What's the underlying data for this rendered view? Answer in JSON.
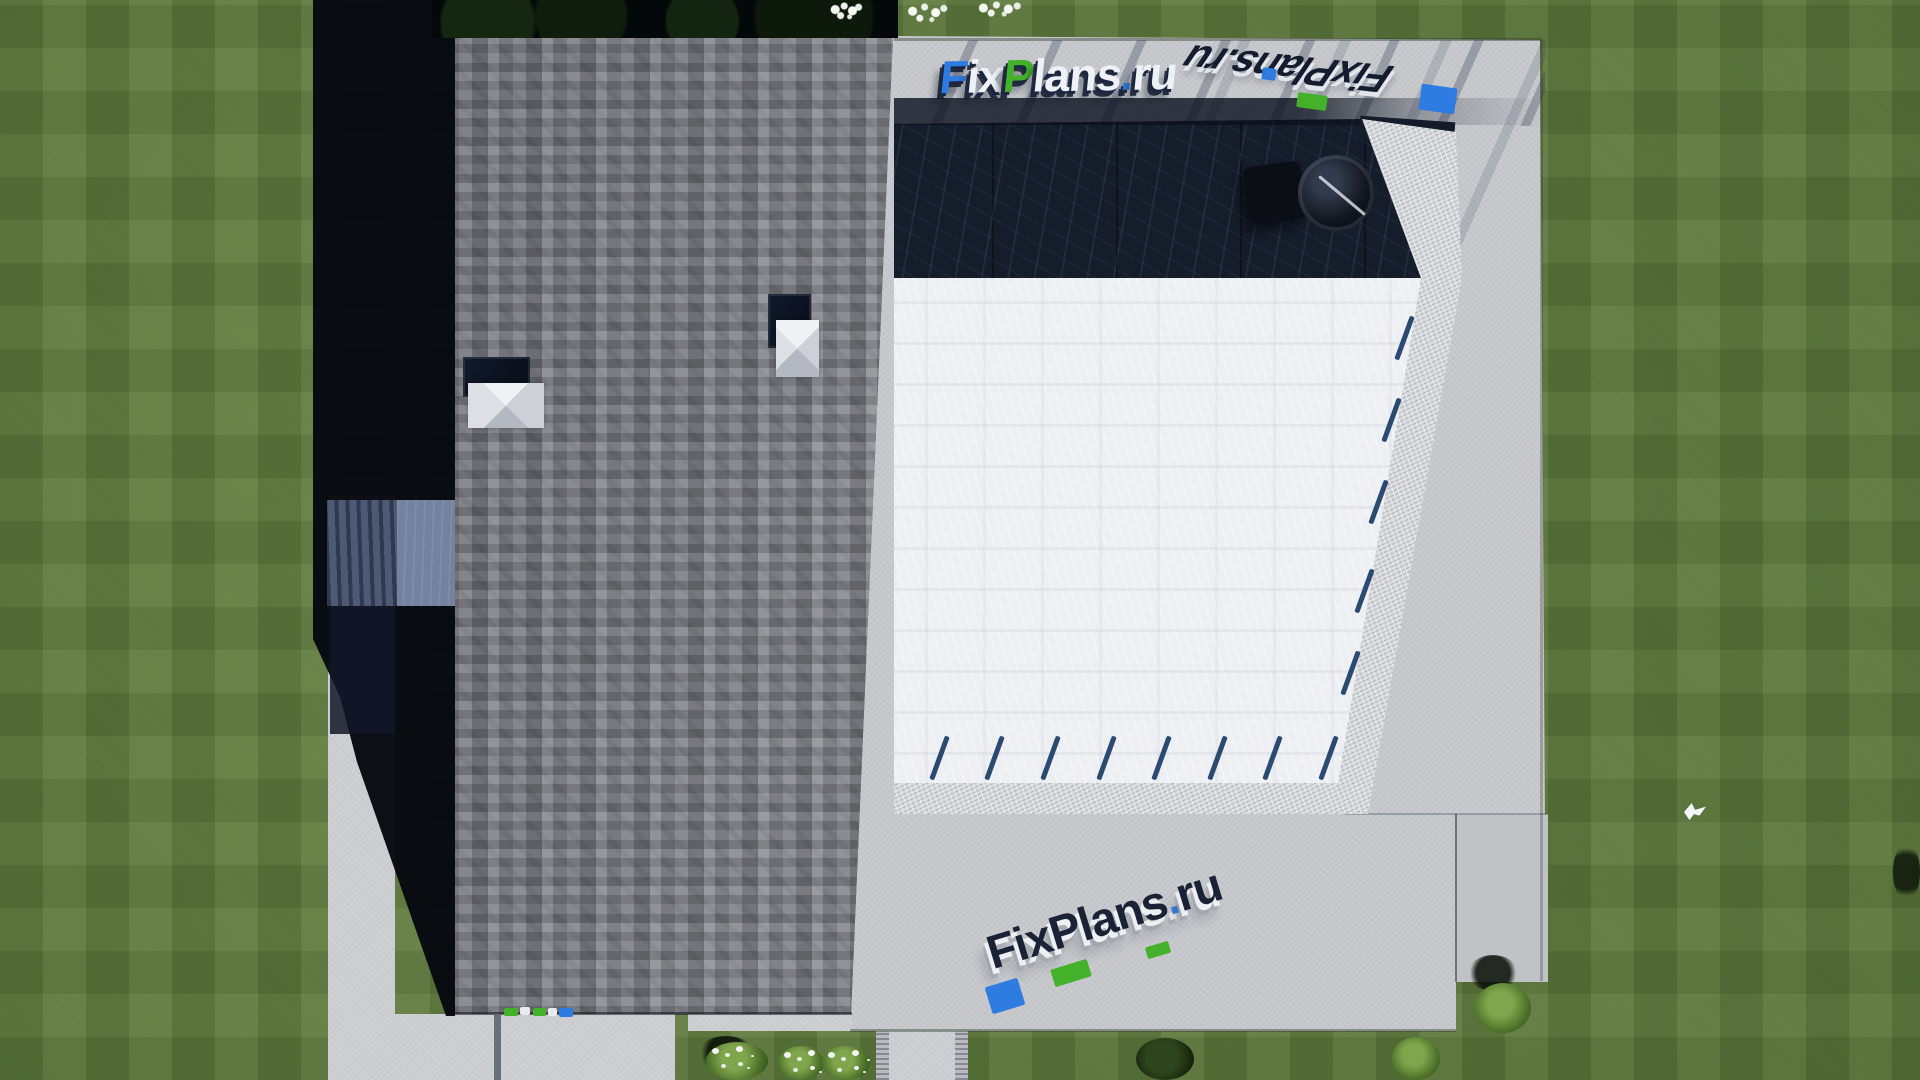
{
  "watermarks": {
    "top": {
      "text": "FixPlans.ru",
      "segments": [
        {
          "t": "F",
          "c": "#2e7ce2"
        },
        {
          "t": "ix",
          "c": "#eef1f6"
        },
        {
          "t": "P",
          "c": "#43b22a"
        },
        {
          "t": "lans",
          "c": "#eef1f6"
        },
        {
          "t": ".",
          "c": "#2e7ce2"
        },
        {
          "t": "ru",
          "c": "#eef1f6"
        }
      ]
    },
    "top_right_mirrored": {
      "text": "FixPlans.ru"
    },
    "bottom": {
      "text": "FixPlans.ru",
      "segments": [
        {
          "t": "FixPlans",
          "c": "#1a2336"
        },
        {
          "t": ".",
          "c": "#2e7ce2"
        },
        {
          "t": "ru",
          "c": "#1a2336"
        }
      ]
    }
  },
  "colors": {
    "lawn": "#5d7a3c",
    "lawn_dark": "#4a6330",
    "roof": "#7d7e85",
    "decking": "#151c2a",
    "pergola_white": "#edeff2",
    "pavement": "#c6c8cc",
    "pavement_bright": "#d7d9db",
    "path": "#cdced2",
    "shadow": "#06080e",
    "brand_blue": "#2e7ce2",
    "brand_green": "#43b22a",
    "slat_navy": "#2b4a72",
    "canopy_dark": "#4d5a76",
    "canopy_light": "#75829f"
  }
}
